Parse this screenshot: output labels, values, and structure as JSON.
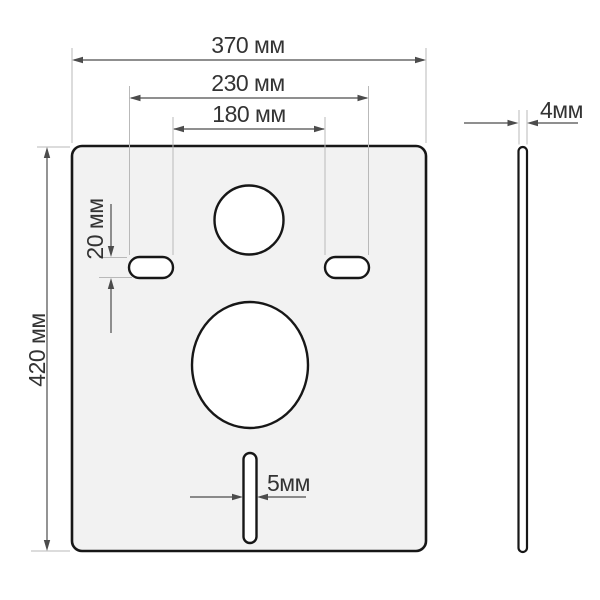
{
  "drawing": {
    "unit": "мм",
    "dims": {
      "plate_width": {
        "label": "370 мм",
        "value": 370
      },
      "slots_outer_span": {
        "label": "230 мм",
        "value": 230
      },
      "slots_inner_span": {
        "label": "180 мм",
        "value": 180
      },
      "slot_height": {
        "label": "20 мм",
        "value": 20
      },
      "plate_height": {
        "label": "420 мм",
        "value": 420
      },
      "bottom_slot_width": {
        "label": "5мм",
        "value": 5
      },
      "thickness": {
        "label": "4мм",
        "value": 4
      }
    },
    "colors": {
      "background": "#ffffff",
      "plate_fill": "#f2f2f2",
      "outline": "#171717",
      "dimension_line": "#4c4c4c",
      "extension_line": "#b9b9b9",
      "label_text": "#333333"
    }
  }
}
